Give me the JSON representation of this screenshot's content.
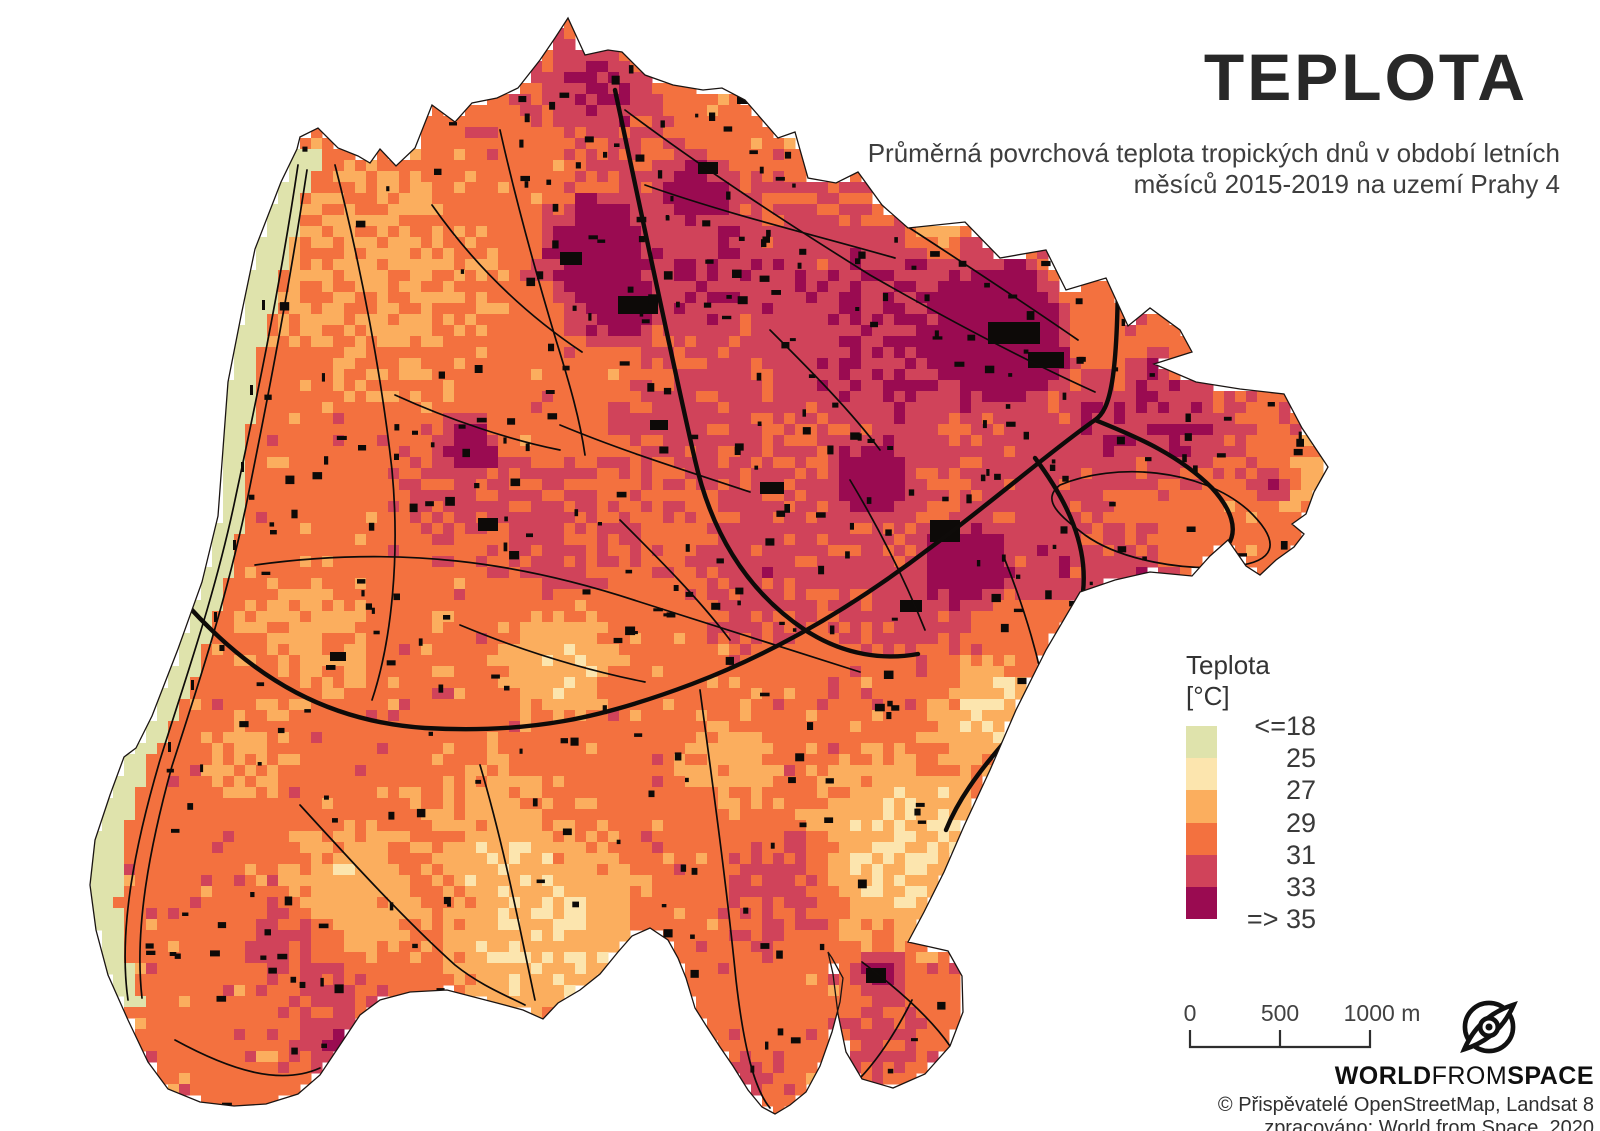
{
  "header": {
    "title": "TEPLOTA",
    "subtitle1": "Průměrná povrchová teplota tropických dnů v období letních",
    "subtitle2": "měsíců 2015-2019 na uzemí Prahy 4"
  },
  "legend": {
    "title": "Teplota [°C]",
    "labels": [
      "<=18",
      "25",
      "27",
      "29",
      "31",
      "33",
      "=> 35"
    ],
    "colors": [
      "#dfe3ac",
      "#fce5ae",
      "#fbae5e",
      "#f3713f",
      "#d0435a",
      "#9a0b51"
    ]
  },
  "scalebar": {
    "labels": [
      "0",
      "500",
      "1000 m"
    ]
  },
  "branding": {
    "logo_icon": "planet-orbit-icon",
    "name_parts": [
      "WORLD",
      "FROM",
      "SPACE"
    ],
    "attribution1": "© Přispěvatelé OpenStreetMap, Landsat 8",
    "attribution2": "zpracováno: World from Space, 2020"
  },
  "map": {
    "road_color": "#0e0b09",
    "building_color": "#0d0a08",
    "outline_color": "#1a1412"
  }
}
